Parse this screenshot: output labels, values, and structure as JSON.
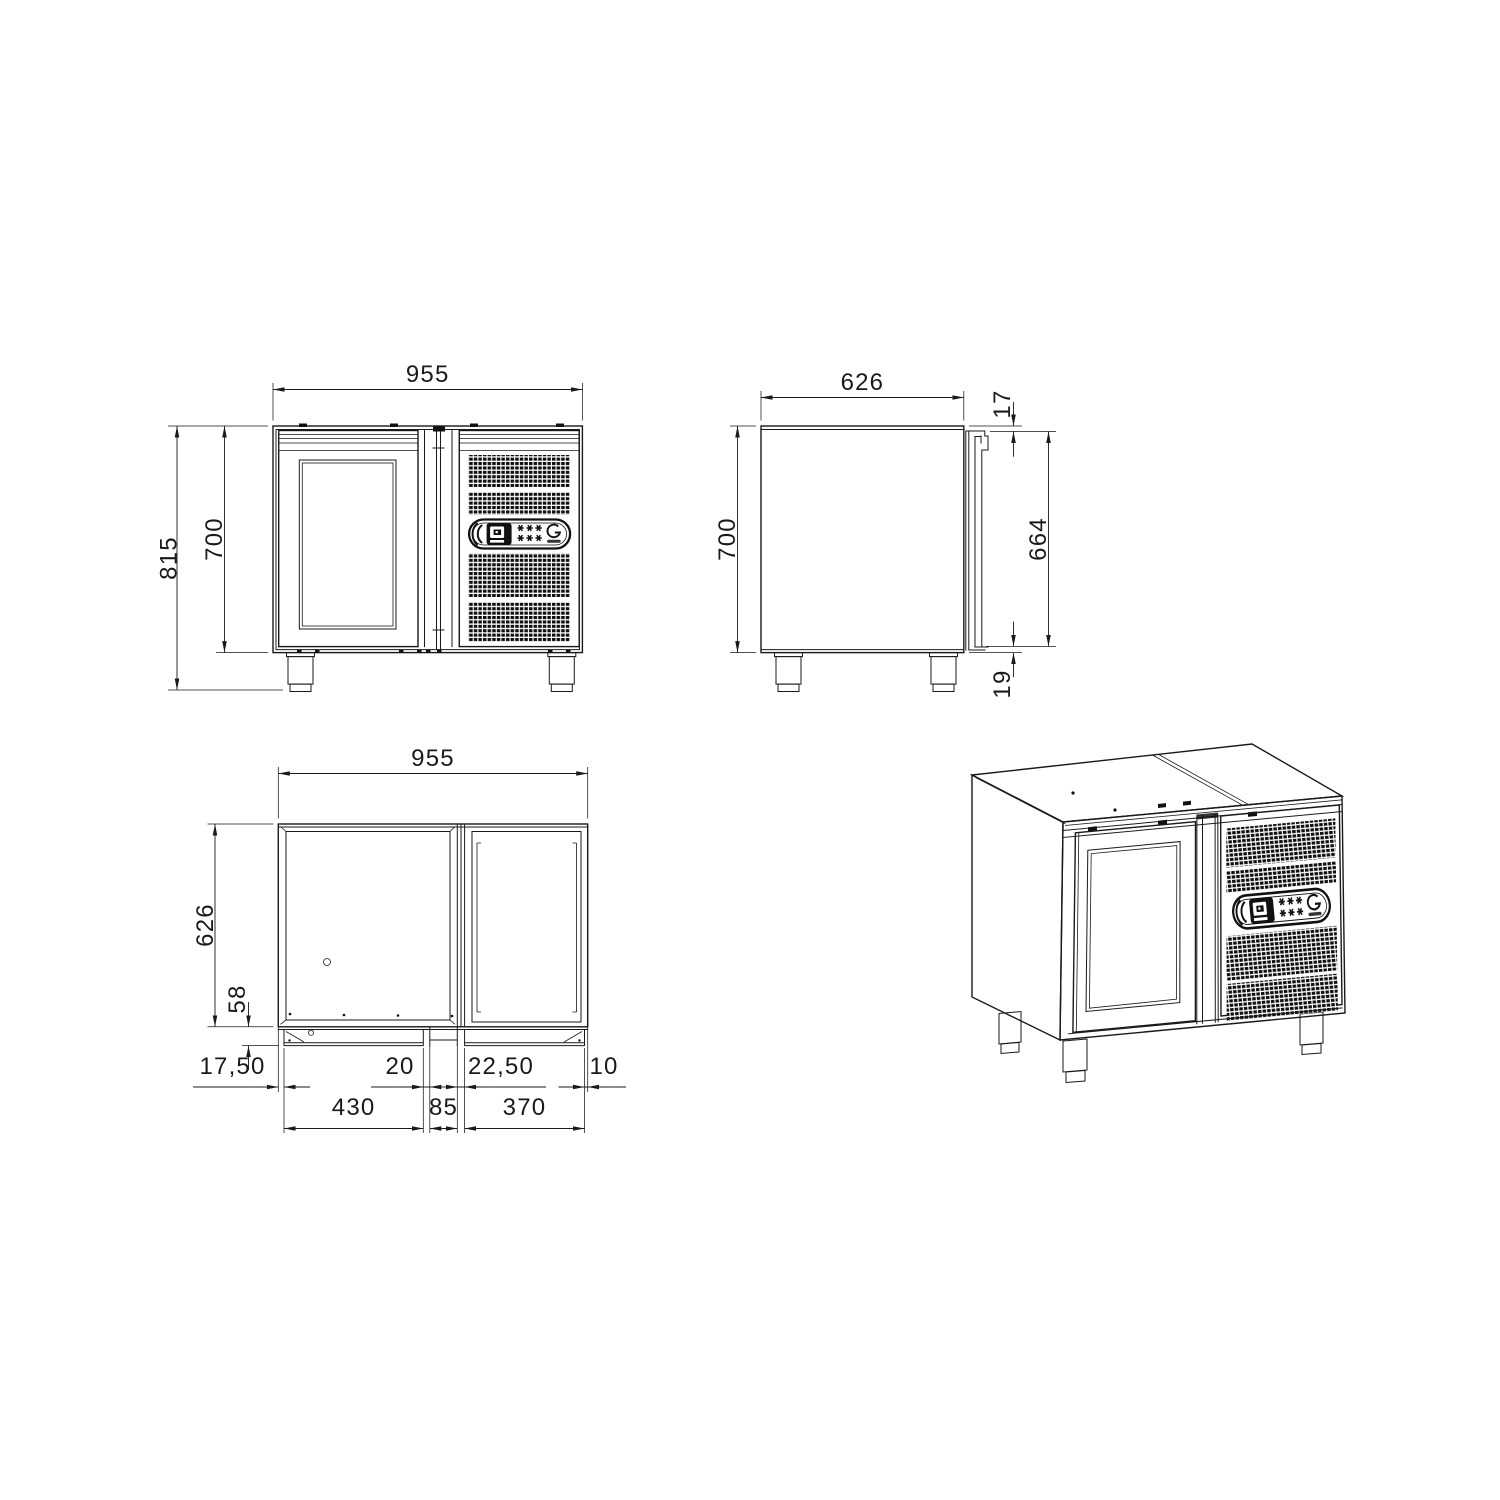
{
  "drawing": {
    "colors": {
      "line": "#1a1a1a",
      "background": "#ffffff",
      "grille_fill": "#101010"
    },
    "badge": {
      "icons": {
        "left": "controller-display-icon",
        "middle": "defrost-snowflake-icons",
        "right": "brand-ring-icon"
      }
    }
  },
  "views": {
    "front": {
      "dims": {
        "width": "955",
        "total_height": "815",
        "body_height": "700"
      }
    },
    "side": {
      "dims": {
        "depth": "626",
        "door_top_offset": "17",
        "body_height": "700",
        "door_height": "664",
        "door_bottom_gap": "19"
      }
    },
    "plan": {
      "dims": {
        "width": "955",
        "depth": "626",
        "door_protrusion": "58",
        "left_margin": "17,50",
        "left_door_width": "430",
        "left_gap": "20",
        "center_post_width": "85",
        "right_gap": "22,50",
        "right_door_width": "370",
        "right_margin": "10"
      }
    }
  }
}
